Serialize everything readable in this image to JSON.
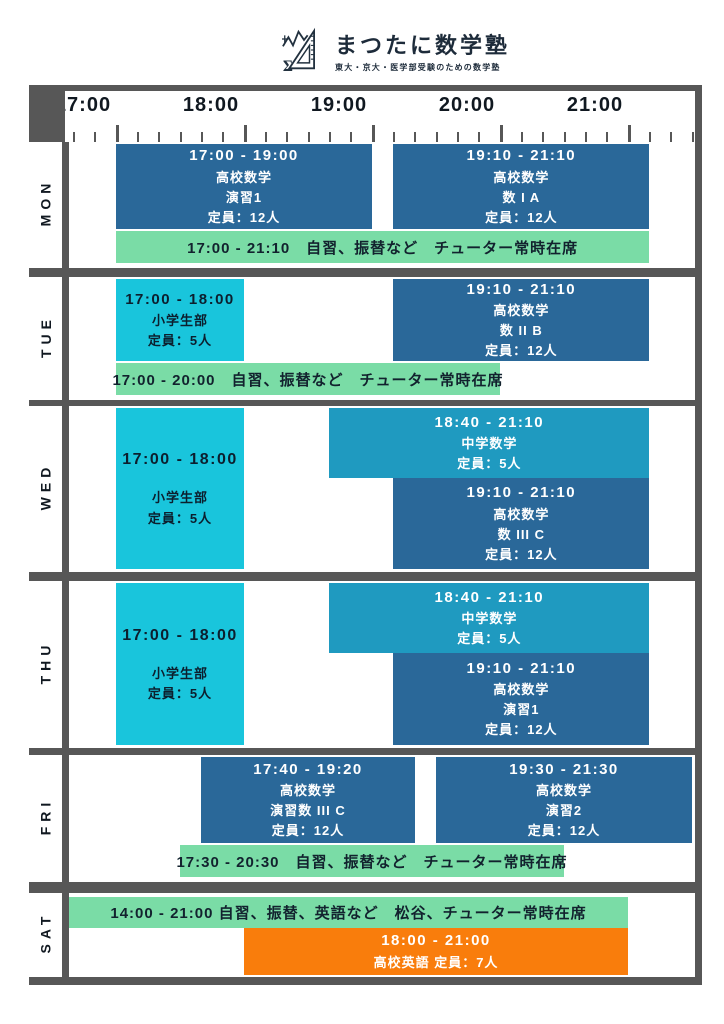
{
  "header": {
    "title": "まつたに数学塾",
    "subtitle": "東大・京大・医学部受験のための数学塾"
  },
  "time_axis": {
    "labels": [
      "17:00",
      "18:00",
      "19:00",
      "20:00",
      "21:00"
    ]
  },
  "colors": {
    "frame": "#575757",
    "class_blue": "#2a6899",
    "class_cyan": "#19c5dc",
    "class_teal": "#1f9ac0",
    "note_green": "#7adca6",
    "class_orange": "#f97d0c"
  },
  "days": [
    {
      "label": "MON",
      "classes": [
        {
          "time": "17:00 - 19:00",
          "start": "17:00",
          "end": "19:00",
          "lines": [
            "高校数学",
            "演習1",
            "定員：12人"
          ],
          "color": "blue",
          "band": "main"
        },
        {
          "time": "19:10 - 21:10",
          "start": "19:10",
          "end": "21:10",
          "lines": [
            "高校数学",
            "数 I A",
            "定員：12人"
          ],
          "color": "blue",
          "band": "main"
        }
      ],
      "note": {
        "text": "17:00 - 21:10　自習、振替など　チューター常時在席",
        "start": "17:00",
        "end": "21:10",
        "position": "bottom"
      }
    },
    {
      "label": "TUE",
      "classes": [
        {
          "time": "17:00 - 18:00",
          "start": "17:00",
          "end": "18:00",
          "lines": [
            "小学生部",
            "定員：5人"
          ],
          "color": "cyan",
          "band": "main"
        },
        {
          "time": "19:10 - 21:10",
          "start": "19:10",
          "end": "21:10",
          "lines": [
            "高校数学",
            "数 II B",
            "定員：12人"
          ],
          "color": "blue",
          "band": "main"
        }
      ],
      "note": {
        "text": "17:00 - 20:00　自習、振替など　チューター常時在席",
        "start": "17:00",
        "end": "20:00",
        "position": "bottom"
      }
    },
    {
      "label": "WED",
      "classes": [
        {
          "time": "17:00 - 18:00",
          "start": "17:00",
          "end": "18:00",
          "lines": [
            "小学生部",
            "定員：5人"
          ],
          "color": "cyan",
          "band": "full",
          "tall": true
        },
        {
          "time": "18:40 - 21:10",
          "start": "18:40",
          "end": "21:10",
          "lines": [
            "中学数学",
            "定員：5人"
          ],
          "color": "teal",
          "band": "top"
        },
        {
          "time": "19:10 - 21:10",
          "start": "19:10",
          "end": "21:10",
          "lines": [
            "高校数学",
            "数 III C",
            "定員：12人"
          ],
          "color": "blue",
          "band": "bottom"
        }
      ],
      "note": null
    },
    {
      "label": "THU",
      "classes": [
        {
          "time": "17:00 - 18:00",
          "start": "17:00",
          "end": "18:00",
          "lines": [
            "小学生部",
            "定員：5人"
          ],
          "color": "cyan",
          "band": "full",
          "tall": true
        },
        {
          "time": "18:40 - 21:10",
          "start": "18:40",
          "end": "21:10",
          "lines": [
            "中学数学",
            "定員：5人"
          ],
          "color": "teal",
          "band": "top"
        },
        {
          "time": "19:10 - 21:10",
          "start": "19:10",
          "end": "21:10",
          "lines": [
            "高校数学",
            "演習1",
            "定員：12人"
          ],
          "color": "blue",
          "band": "bottom"
        }
      ],
      "note": null
    },
    {
      "label": "FRI",
      "classes": [
        {
          "time": "17:40 - 19:20",
          "start": "17:40",
          "end": "19:20",
          "lines": [
            "高校数学",
            "演習数 III C",
            "定員：12人"
          ],
          "color": "blue",
          "band": "main"
        },
        {
          "time": "19:30 - 21:30",
          "start": "19:30",
          "end": "21:30",
          "lines": [
            "高校数学",
            "演習2",
            "定員：12人"
          ],
          "color": "blue",
          "band": "main"
        }
      ],
      "note": {
        "text": "17:30 - 20:30　自習、振替など　チューター常時在席",
        "start": "17:30",
        "end": "20:30",
        "position": "bottom"
      }
    },
    {
      "label": "SAT",
      "classes": [
        {
          "time": "18:00 - 21:00",
          "start": "18:00",
          "end": "21:00",
          "lines": [
            "高校英語 定員：7人"
          ],
          "color": "orange",
          "band": "sat"
        }
      ],
      "note": {
        "text": "14:00 - 21:00 自習、振替、英語など　松谷、チューター常時在席",
        "start": "14:00",
        "end": "21:00",
        "position": "top"
      }
    }
  ]
}
